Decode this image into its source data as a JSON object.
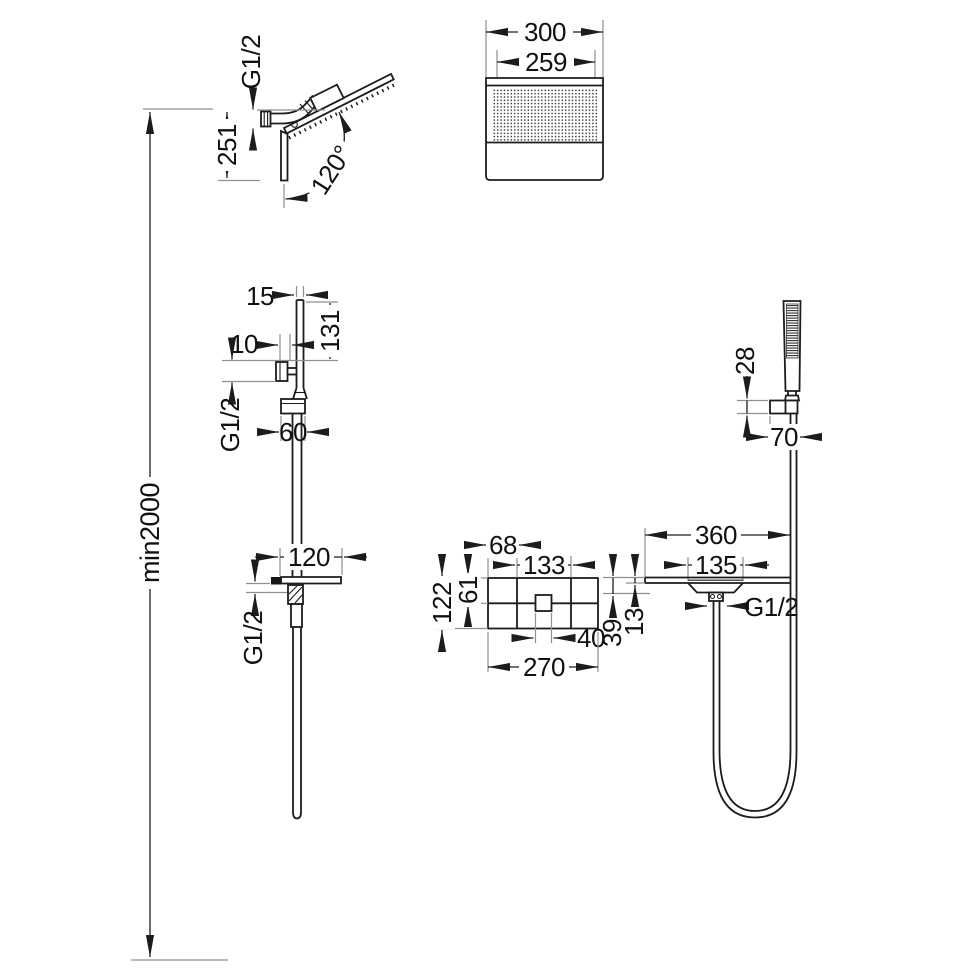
{
  "drawing": {
    "type": "technical-dimension-drawing",
    "subject": "wall-mounted shower system installation dimensions",
    "units": "mm",
    "colors": {
      "line": "#1c1c1c",
      "extension_line": "#8f8f8f",
      "background": "#ffffff",
      "text": "#111111"
    },
    "labels": {
      "head_side_thread": "G1/2",
      "head_side_height": "251",
      "head_angle": "120°",
      "head_front_width": "300",
      "head_front_face_width": "259",
      "min_install_height": "min2000",
      "riser_pipe_width": "15",
      "riser_top_to_inlet": "131",
      "riser_inlet_offset": "10",
      "riser_thread": "G1/2",
      "riser_union_width": "60",
      "handshower_holder_height": "28",
      "handshower_holder_width": "70",
      "spout_length": "120",
      "spout_thread": "G1/2",
      "plate_left_offset": "68",
      "plate_center_width": "133",
      "plate_height": "122",
      "plate_center_height": "61",
      "plate_handle_width": "40",
      "plate_width": "270",
      "shelf_width": "360",
      "shelf_recess_width": "135",
      "shelf_depth": "39",
      "shelf_thickness": "13",
      "shelf_thread": "G1/2"
    }
  }
}
